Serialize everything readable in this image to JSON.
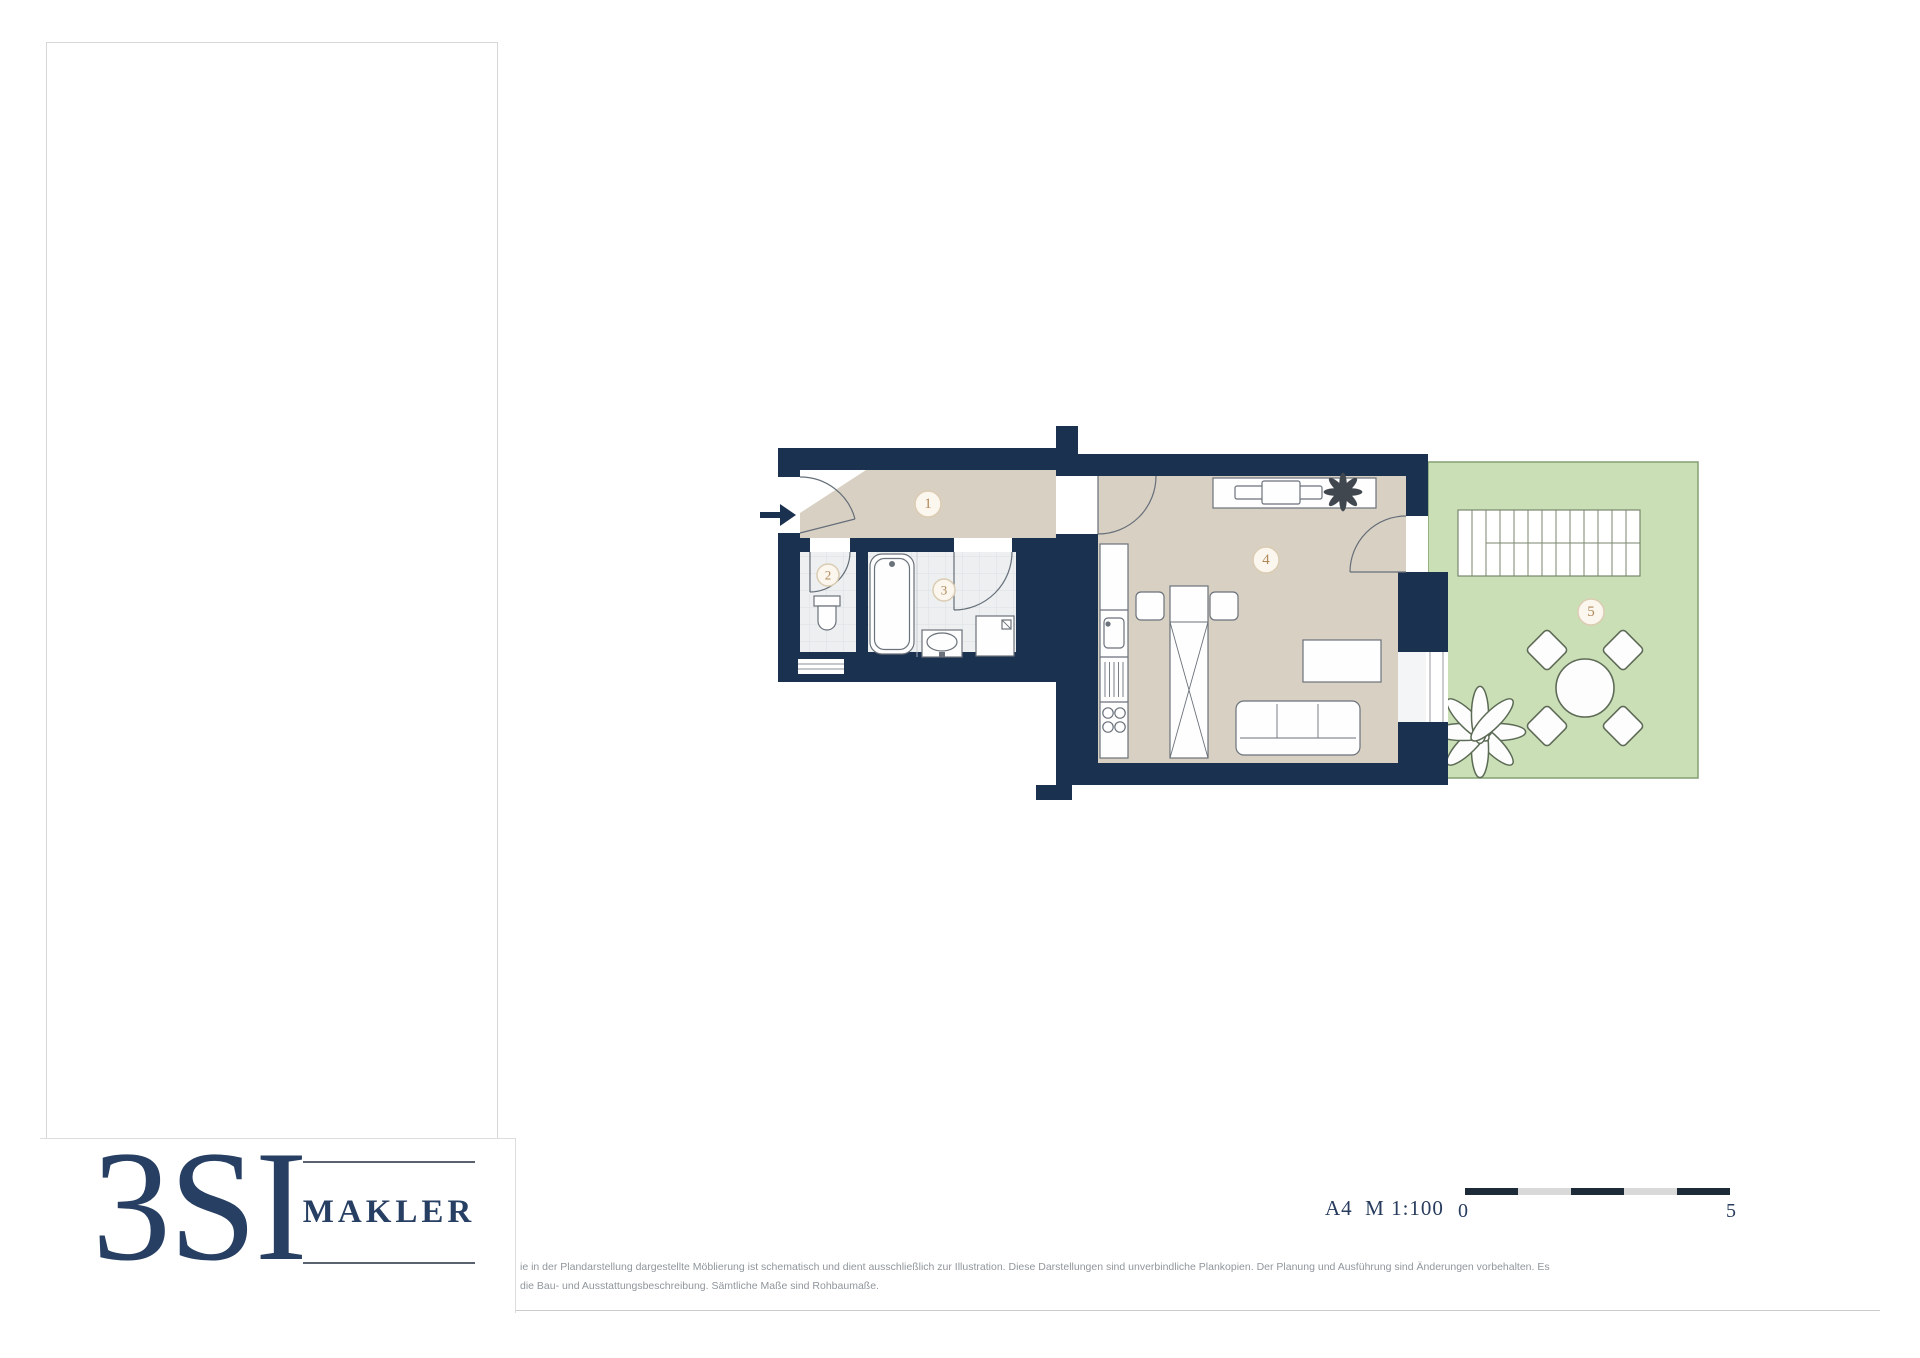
{
  "brand": {
    "name": "3SI",
    "immo_line1": "IMMO",
    "immo_line2": "GROUP",
    "makler": "MAKLER"
  },
  "property": {
    "street": "Hainburger Straße 47",
    "city": "1030 Wien",
    "unit": "Top 6 • EG"
  },
  "areas": [
    {
      "label": "Wohnfläche",
      "value": "32,79 m²"
    },
    {
      "label": "Garten",
      "value": "30,60 m²"
    }
  ],
  "legend": [
    {
      "num": "1",
      "label": "Vorraum"
    },
    {
      "num": "2",
      "label": "WC"
    },
    {
      "num": "3",
      "label": "Bad"
    },
    {
      "num": "4",
      "label": "Wohnen/Kochen/Schlafen"
    },
    {
      "num": "5",
      "label": "Mietergarten"
    }
  ],
  "plan": {
    "labels": [
      "1",
      "2",
      "3",
      "4",
      "5"
    ]
  },
  "scale": {
    "label": "A4  M 1:100",
    "start": "0",
    "end": "5"
  },
  "disclaimer": {
    "line1": "ie in der Plandarstellung dargestellte Möblierung ist schematisch und dient ausschließlich zur Illustration. Diese Darstellungen sind unverbindliche Plankopien. Der Planung und Ausführung sind Änderungen vorbehalten. Es",
    "line2": "die Bau- und Ausstattungsbeschreibung. Sämtliche Maße sind Rohbaumaße."
  },
  "colors": {
    "navy": "#1b3150",
    "beige": "#d8d0c3",
    "tan": "#bd9168",
    "green": "#cbdfb7"
  }
}
